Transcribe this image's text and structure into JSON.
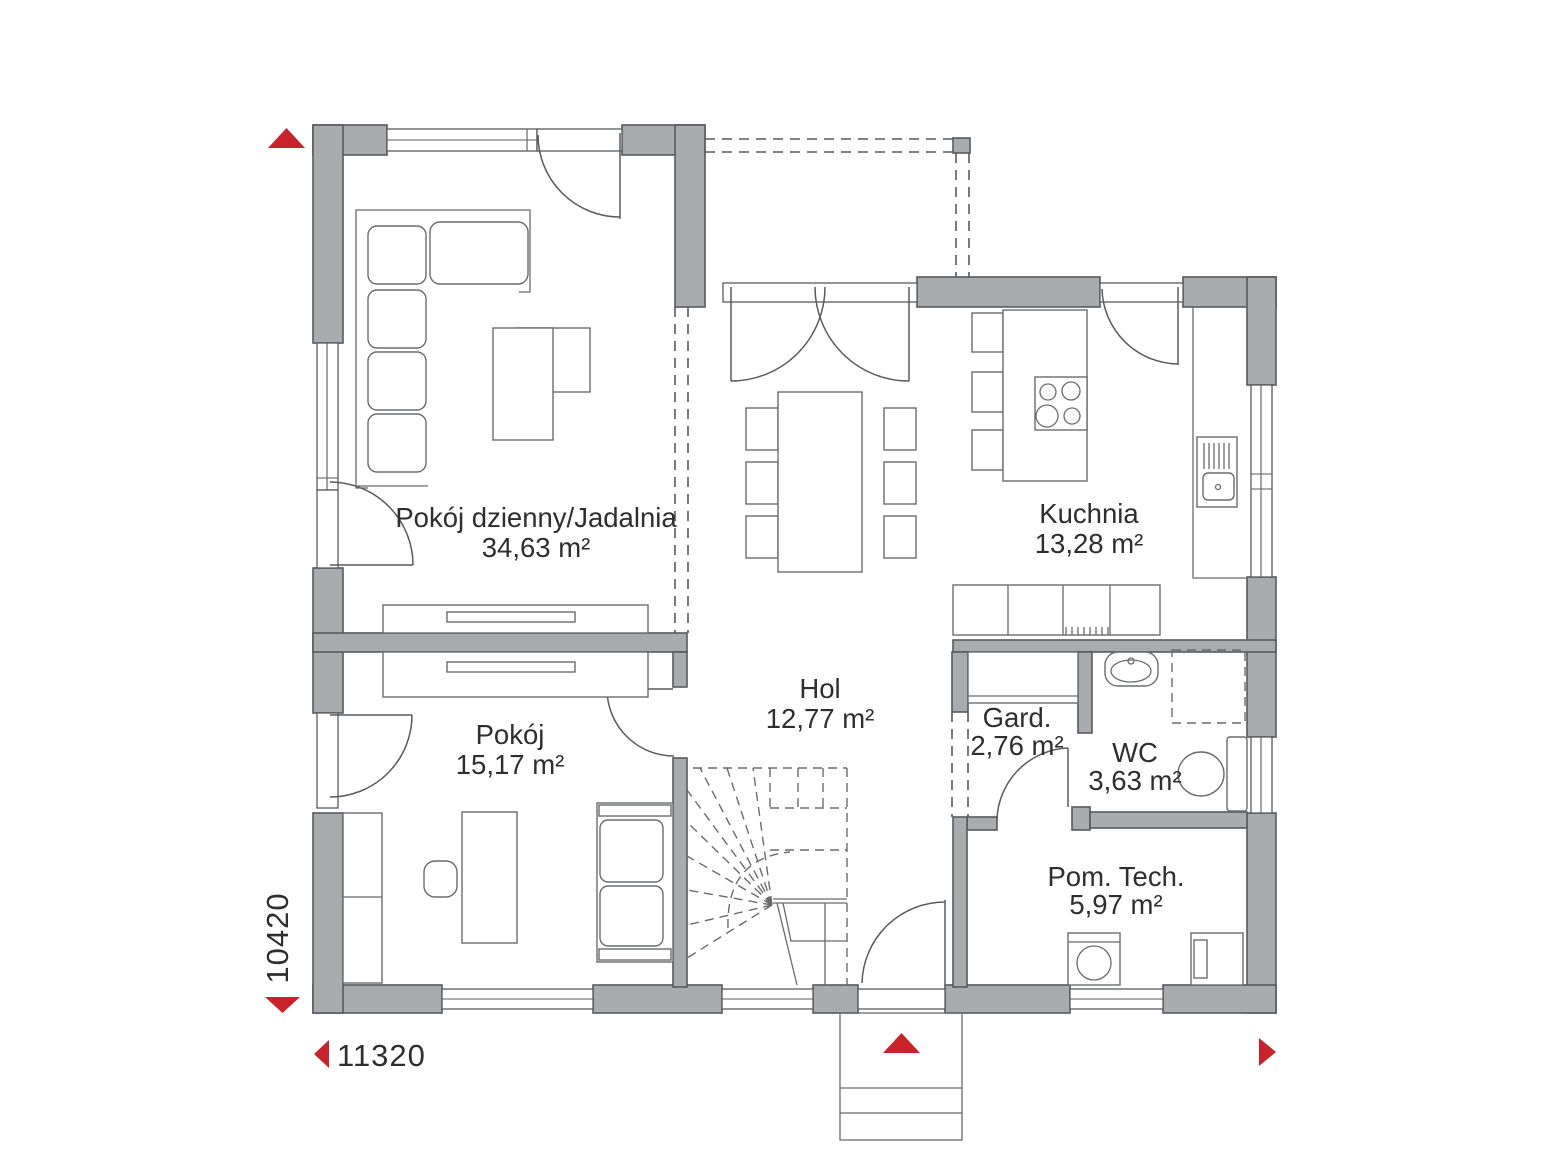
{
  "colors": {
    "wall": "#a9abae",
    "accent": "#c8232b"
  },
  "rooms": [
    {
      "name": "Pokój dzienny/Jadalnia",
      "area": "34,63 m²"
    },
    {
      "name": "Kuchnia",
      "area": "13,28 m²"
    },
    {
      "name": "Hol",
      "area": "12,77 m²"
    },
    {
      "name": "Pokój",
      "area": "15,17 m²"
    },
    {
      "name": "Gard.",
      "area": "2,76 m²"
    },
    {
      "name": "WC",
      "area": "3,63 m²"
    },
    {
      "name": "Pom. Tech.",
      "area": "5,97 m²"
    }
  ],
  "dimensions": {
    "height_mm": "10420",
    "width_mm": "11320"
  }
}
